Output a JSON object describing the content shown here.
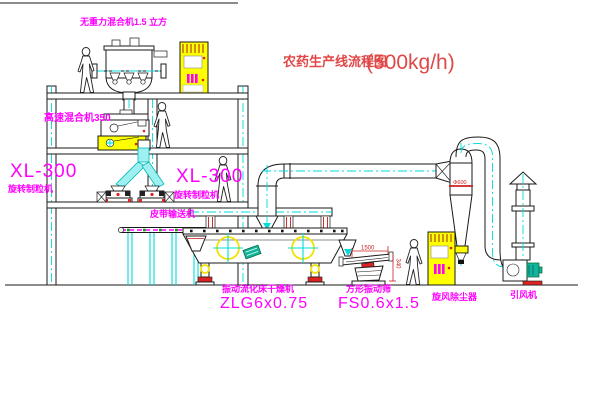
{
  "title": {
    "name": "农药生产线流程图",
    "capacity": "(500kg/h)"
  },
  "labels": {
    "gravity_mixer": "无重力混合机1.5 立方",
    "high_speed_mixer": "高速混合机350",
    "granulator_left_model": "XL-300",
    "granulator_left_name": "旋转制粒机",
    "granulator_right_model": "XL-300",
    "granulator_right_name": "旋转制粒机",
    "belt_conveyor": "皮带输送机",
    "fluid_bed_dryer_name": "振动流化床干燥机",
    "fluid_bed_dryer_model": "ZLG6x0.75",
    "vibrating_screen_name": "方形振动筛",
    "vibrating_screen_model": "FS0.6x1.5",
    "cyclone_dust_collector": "旋风除尘器",
    "induced_draft_fan": "引风机"
  },
  "dimensions": {
    "screen_length": "1500",
    "screen_height": "340",
    "cyclone_diameter": "Φ600"
  },
  "colors": {
    "label_magenta": "#ff00ff",
    "title_red": "#e04848",
    "dimension_red": "#cc2020",
    "pipe_cyan": "#00dcdc",
    "highlight_yellow": "#ffff00",
    "motor_teal": "#14b39c"
  }
}
